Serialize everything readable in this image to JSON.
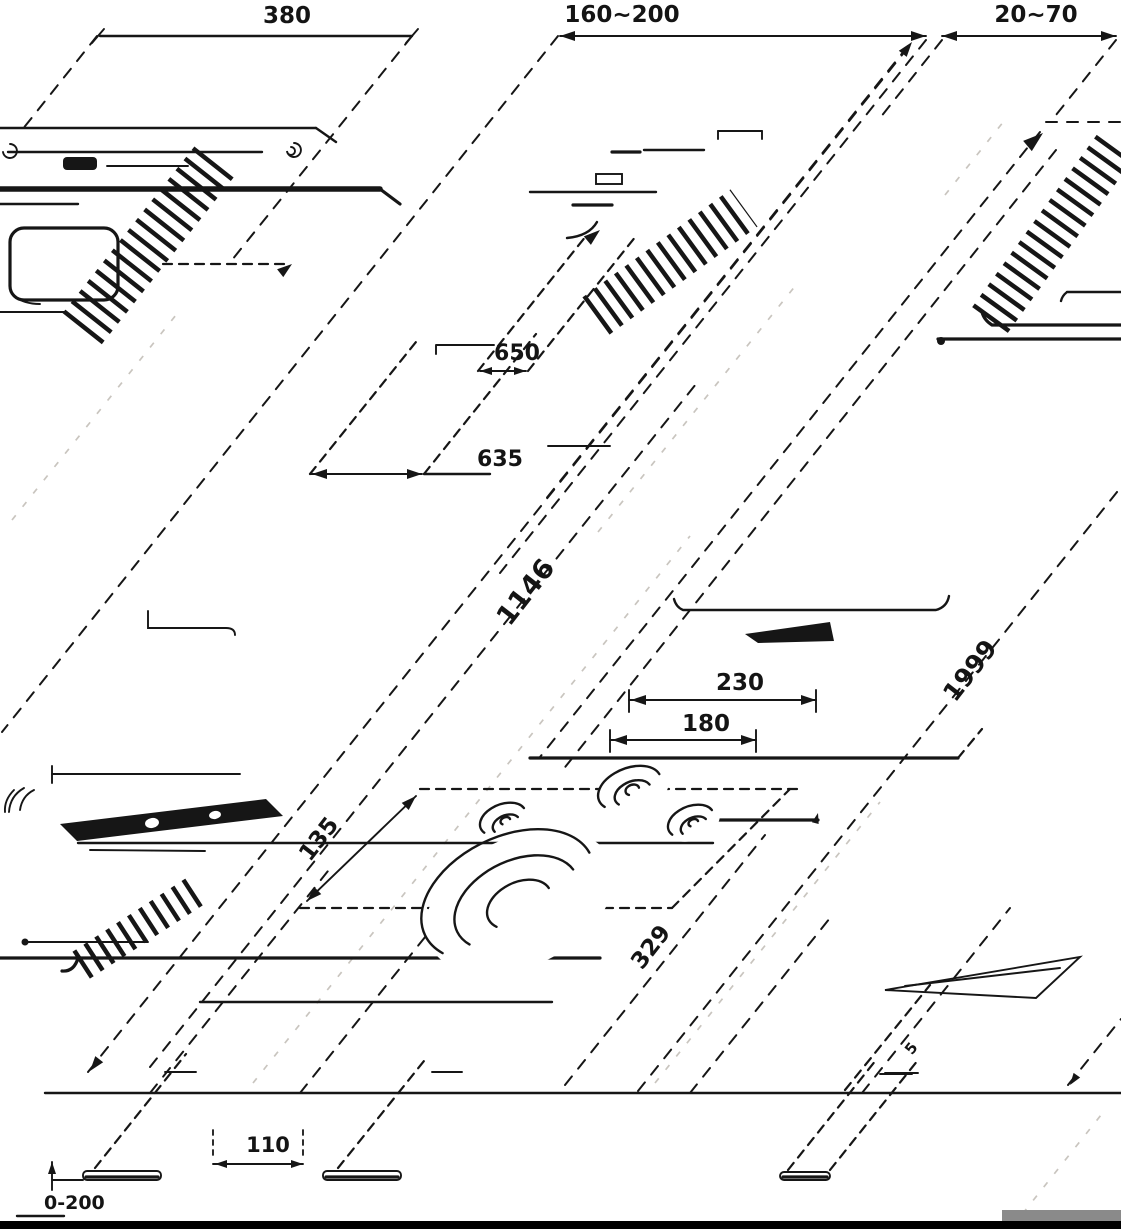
{
  "diagram": {
    "background": "#ffffff",
    "ink_color": "#161616",
    "light_line_color": "#c9c5bf",
    "labels": {
      "hood_width": "380",
      "duct_offset": "160~200",
      "wall_gap": "20~70",
      "clearance_upper": "650",
      "clearance_lower": "635",
      "mid_height": "1146",
      "burner_pitch_wide": "230",
      "burner_pitch_narrow": "180",
      "cutout_inset": "135",
      "hob_depth": "329",
      "overall_height": "1999",
      "foot_spacing": "110",
      "adjust_range": "0-200",
      "shim_thickness": "5"
    }
  }
}
